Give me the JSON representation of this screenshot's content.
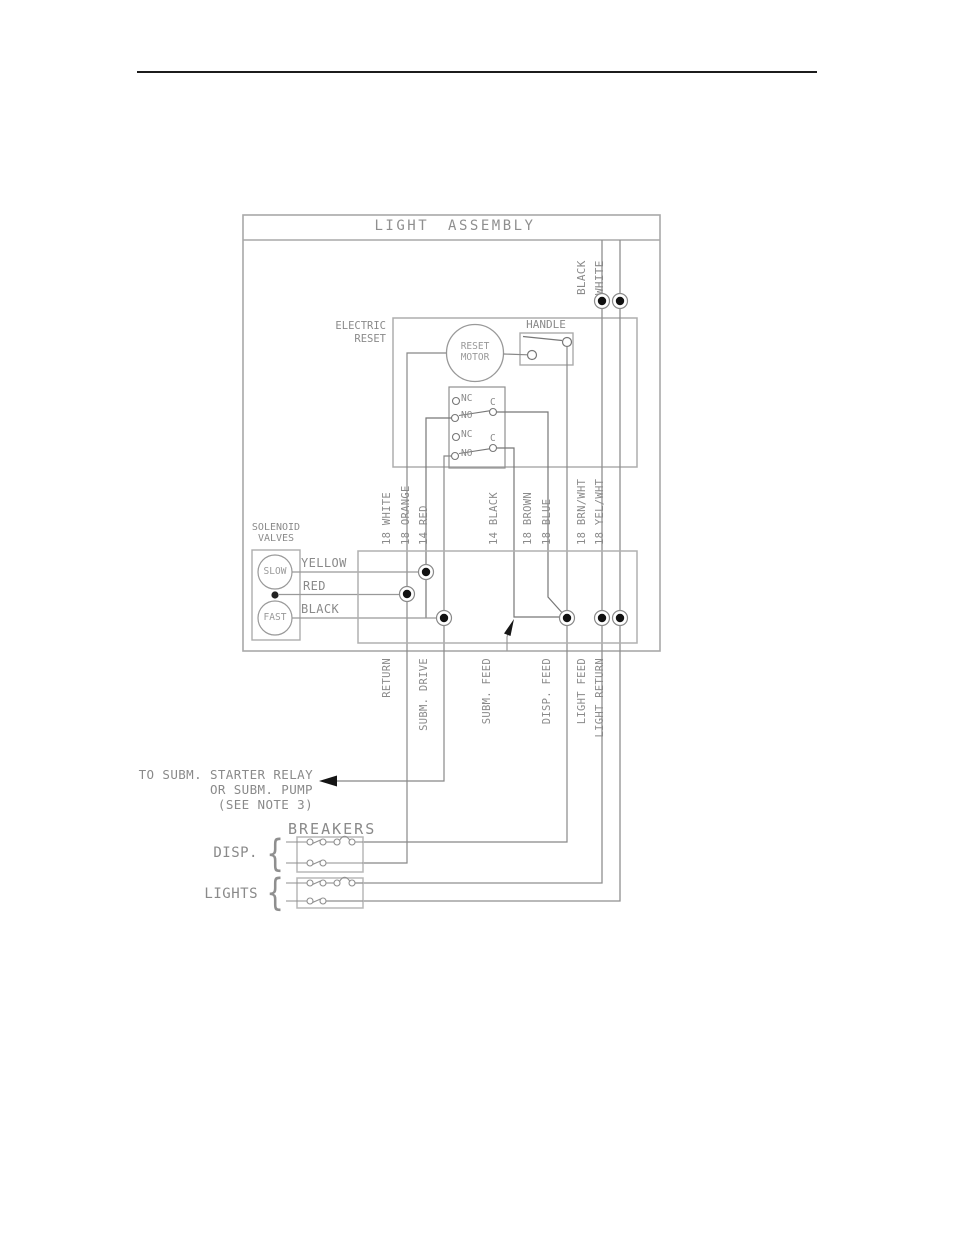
{
  "diagram": {
    "title": "LIGHT ASSEMBLY",
    "top_wires": [
      "BLACK",
      "WHITE"
    ],
    "electric_reset": {
      "label1": "ELECTRIC",
      "label2": "RESET",
      "motor1": "RESET",
      "motor2": "MOTOR",
      "handle": "HANDLE"
    },
    "contacts": {
      "nc": "NC",
      "no": "NO",
      "c": "C"
    },
    "solenoid": {
      "label1": "SOLENOID",
      "label2": "VALVES",
      "slow": "SLOW",
      "fast": "FAST",
      "wires": [
        "YELLOW",
        "RED",
        "BLACK"
      ]
    },
    "wire_labels_top": [
      "18 WHITE",
      "18 ORANGE",
      "14 RED",
      "14 BLACK",
      "18 BROWN",
      "18 BLUE",
      "18 BRN/WHT",
      "18 YEL/WHT"
    ],
    "wire_labels_bottom": [
      "RETURN",
      "SUBM. DRIVE",
      "SUBM. FEED",
      "DISP. FEED",
      "LIGHT FEED",
      "LIGHT RETURN"
    ],
    "note": {
      "line1": "TO SUBM. STARTER RELAY",
      "line2": "OR SUBM. PUMP",
      "line3": "(SEE NOTE 3)"
    },
    "breakers": {
      "title": "BREAKERS",
      "disp": "DISP.",
      "lights": "LIGHTS",
      "brace": "{"
    }
  }
}
